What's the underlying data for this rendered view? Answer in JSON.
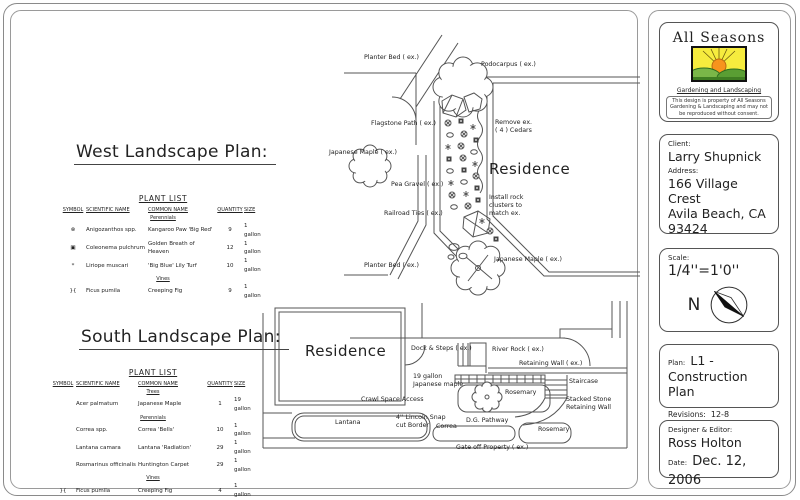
{
  "logo": {
    "title": "All Seasons",
    "subtitle": "Gardening and Landscaping",
    "disclaimer": "This design is property of All Seasons Gardening & Landscaping and may not be reproduced without consent."
  },
  "client_block": {
    "client_label": "Client:",
    "client_name": "Larry Shupnick",
    "address_label": "Address:",
    "address_line1": "166 Village Crest",
    "address_line2": "Avila Beach, CA",
    "address_line3": "93424"
  },
  "scale_block": {
    "label": "Scale:",
    "value": "1/4''=1'0''",
    "north": "N"
  },
  "plan_block": {
    "label": "Plan:",
    "value": "L1 -",
    "line2": "Construction Plan",
    "revisions_label": "Revisions:",
    "revisions": "12-8"
  },
  "designer_block": {
    "label": "Designer & Editor:",
    "name": "Ross Holton",
    "date_label": "Date:",
    "date": "Dec. 12, 2006"
  },
  "west": {
    "title": "West Landscape Plan:",
    "plant_list": {
      "title": "PLANT LIST",
      "headers": [
        "SYMBOL",
        "SCIENTIFIC NAME",
        "COMMON NAME",
        "QUANTITY",
        "SIZE"
      ],
      "sections": [
        {
          "name": "Perennials",
          "rows": [
            {
              "symbol": "⊗",
              "scientific": "Anigozanthos spp.",
              "common": "Kangaroo Paw 'Big Red'",
              "qty": "9",
              "size": "1 gallon"
            },
            {
              "symbol": "▣",
              "scientific": "Coleonema pulchrum",
              "common": "Golden Breath of Heaven",
              "qty": "12",
              "size": "1 gallon"
            },
            {
              "symbol": "*",
              "scientific": "Liriope muscari",
              "common": "'Big Blue' Lily Turf",
              "qty": "10",
              "size": "1 gallon"
            }
          ]
        },
        {
          "name": "Vines",
          "rows": [
            {
              "symbol": "}{",
              "scientific": "Ficus pumila",
              "common": "Creeping Fig",
              "qty": "9",
              "size": "1 gallon"
            }
          ]
        }
      ]
    },
    "labels": {
      "planter_bed_top": "Planter Bed ( ex.)",
      "podocarpus": "Podocarpus ( ex.)",
      "flagstone": "Flagstone Path ( ex.)",
      "maple_left": "Japanese Maple ( ex.)",
      "pea_gravel": "Pea Gravel ( ex.)",
      "railroad": "Railroad Ties ( ex.)",
      "planter_bed_bottom": "Planter Bed ( ex.)",
      "remove_cedars": "Remove ex.\n( 4 ) Cedars",
      "residence": "Residence",
      "install_rock": "Install rock\nclusters to\nmatch ex.",
      "maple_right": "Japanese Maple ( ex.)"
    }
  },
  "south": {
    "title": "South Landscape Plan:",
    "plant_list": {
      "title": "PLANT LIST",
      "headers": [
        "SYMBOL",
        "SCIENTIFIC NAME",
        "COMMON NAME",
        "QUANTITY",
        "SIZE"
      ],
      "sections": [
        {
          "name": "Trees",
          "rows": [
            {
              "symbol": "",
              "scientific": "Acer palmatum",
              "common": "Japanese Maple",
              "qty": "1",
              "size": "19 gallon"
            }
          ]
        },
        {
          "name": "Perennials",
          "rows": [
            {
              "symbol": "",
              "scientific": "Correa spp.",
              "common": "Correa 'Bells'",
              "qty": "10",
              "size": "1 gallon"
            },
            {
              "symbol": "",
              "scientific": "Lantana camara",
              "common": "Lantana 'Radiation'",
              "qty": "29",
              "size": "1 gallon"
            },
            {
              "symbol": "",
              "scientific": "Rosmarinus officinalis",
              "common": "Huntington Carpet",
              "qty": "29",
              "size": "1 gallon"
            }
          ]
        },
        {
          "name": "Vines",
          "rows": [
            {
              "symbol": "}{",
              "scientific": "Ficus pumila",
              "common": "Creeping Fig",
              "qty": "4",
              "size": "1 gallon"
            }
          ]
        }
      ]
    },
    "labels": {
      "residence": "Residence",
      "dock_steps": "Dock & Steps ( ex.)",
      "river_rock": "River Rock ( ex.)",
      "retaining_wall": "Retaining Wall ( ex.)",
      "maple_19": "19 gallon\nJapanese maple",
      "crawl_space": "Crawl Space Access",
      "rosemary_1": "Rosemary",
      "staircase": "Staircase",
      "stacked_stone": "Stacked Stone\nRetaining Wall",
      "dg_pathway": "D.G. Pathway",
      "rosemary_2": "Rosemary",
      "lantana": "Lantana",
      "lincoln_border": "4'' Lincoln Snap\ncut Border",
      "correa": "Correa",
      "gate": "Gate off Property ( ex.)"
    }
  }
}
